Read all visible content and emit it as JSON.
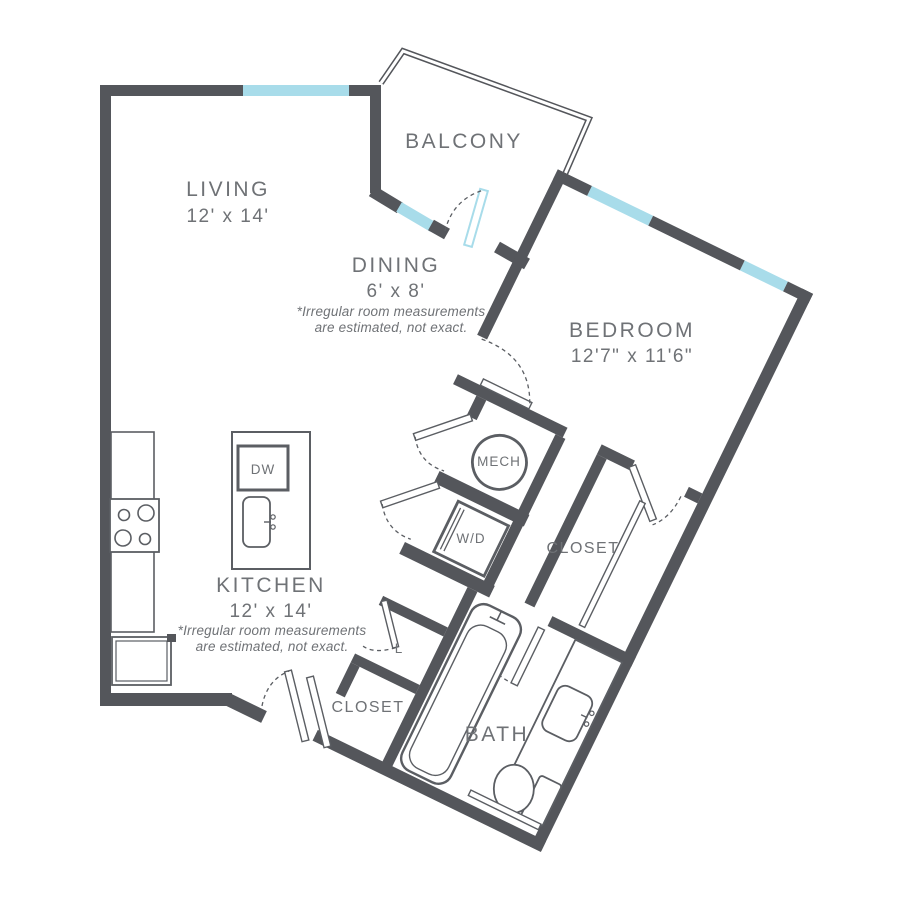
{
  "colors": {
    "wall": "#54565B",
    "window": "#A8DCEA",
    "line": "#5B5E63",
    "label": "#6F7276"
  },
  "rooms": {
    "living": {
      "name": "LIVING",
      "dims": "12' x 14'"
    },
    "dining": {
      "name": "DINING",
      "dims": "6' x 8'"
    },
    "balcony": {
      "name": "BALCONY"
    },
    "bedroom": {
      "name": "BEDROOM",
      "dims": "12'7\" x 11'6\""
    },
    "kitchen": {
      "name": "KITCHEN",
      "dims": "12' x 14'"
    },
    "bath": {
      "name": "BATH"
    },
    "bedroom_closet": {
      "name": "CLOSET"
    },
    "entry_closet": {
      "name": "CLOSET"
    },
    "linen_closet": {
      "name": "L"
    },
    "mech": {
      "name": "MECH"
    },
    "washer_dryer": {
      "name": "W/D"
    },
    "dishwasher": {
      "name": "DW"
    }
  },
  "disclaimer": {
    "line1": "*Irregular room measurements",
    "line2": "are estimated, not exact."
  }
}
